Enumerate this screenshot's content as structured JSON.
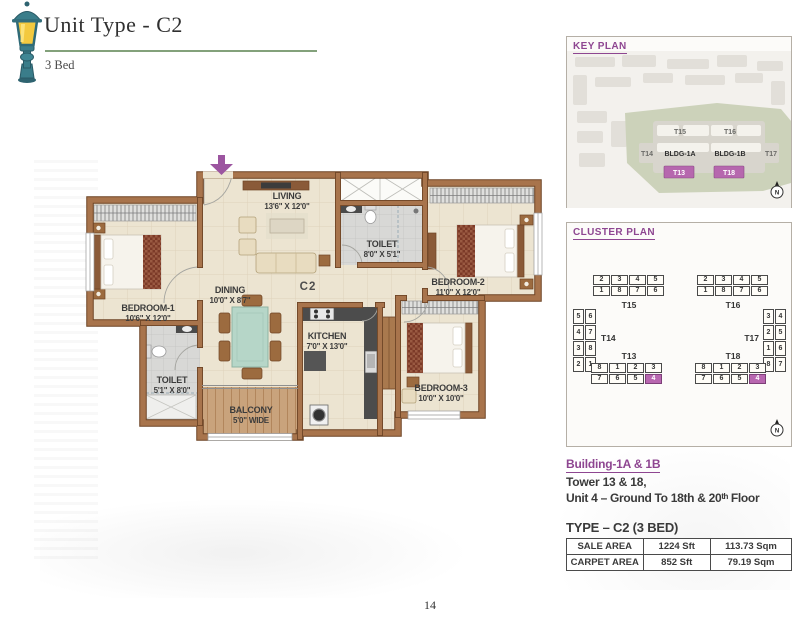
{
  "header": {
    "title": "Unit Type - C2",
    "subtitle": "3 Bed"
  },
  "page_number": "14",
  "accent": {
    "purple": "#8e4691",
    "highlight": "#b867b0",
    "green_rule": "#83a17b",
    "wall_brown": "#a8744c"
  },
  "plan": {
    "unit_label": "C2",
    "rooms": {
      "living": {
        "name": "LIVING",
        "dims": "13'6\" X 12'0\""
      },
      "toilet_top": {
        "name": "TOILET",
        "dims": "8'0\" X 5'1\""
      },
      "bedroom2": {
        "name": "BEDROOM-2",
        "dims": "11'0\" X 12'0\""
      },
      "bedroom1": {
        "name": "BEDROOM-1",
        "dims": "10'6\" X 12'0\""
      },
      "dining": {
        "name": "DINING",
        "dims": "10'0\" X 8'7\""
      },
      "kitchen": {
        "name": "KITCHEN",
        "dims": "7'0\" X 13'0\""
      },
      "toilet_bottom": {
        "name": "TOILET",
        "dims": "5'1\" X 8'0\""
      },
      "balcony": {
        "name": "BALCONY",
        "dims": "5'0\" WIDE"
      },
      "bedroom3": {
        "name": "BEDROOM-3",
        "dims": "10'0\" X 10'0\""
      }
    }
  },
  "key_plan": {
    "title": "KEY PLAN",
    "compass": "N",
    "labels": {
      "t15": "T15",
      "t16": "T16",
      "t14": "T14",
      "t17": "T17",
      "bldg1a": "BLDG-1A",
      "bldg1b": "BLDG-1B",
      "t13": "T13",
      "t18": "T18"
    }
  },
  "cluster_plan": {
    "title": "CLUSTER PLAN",
    "compass": "N",
    "left": {
      "top_label": "T15",
      "side_label": "T14",
      "bottom_label": "T13",
      "t_top_r1": [
        {
          "n": "2"
        },
        {
          "n": "3"
        },
        {
          "n": "4"
        },
        {
          "n": "5"
        }
      ],
      "t_top_r2": [
        {
          "n": "1"
        },
        {
          "n": "8"
        },
        {
          "n": "7"
        },
        {
          "n": "6"
        }
      ],
      "t_side_c1": [
        {
          "n": "5"
        },
        {
          "n": "4"
        },
        {
          "n": "3"
        },
        {
          "n": "2"
        }
      ],
      "t_side_c2": [
        {
          "n": "6"
        },
        {
          "n": "7"
        },
        {
          "n": "8"
        },
        {
          "n": "1"
        }
      ],
      "t_bottom_r1": [
        {
          "n": "8"
        },
        {
          "n": "1"
        },
        {
          "n": "2"
        },
        {
          "n": "3"
        }
      ],
      "t_bottom_r2": [
        {
          "n": "7"
        },
        {
          "n": "6"
        },
        {
          "n": "5"
        },
        {
          "n": "4",
          "hl": true
        }
      ]
    },
    "right": {
      "top_label": "T16",
      "side_label": "T17",
      "bottom_label": "T18",
      "t_top_r1": [
        {
          "n": "2"
        },
        {
          "n": "3"
        },
        {
          "n": "4"
        },
        {
          "n": "5"
        }
      ],
      "t_top_r2": [
        {
          "n": "1"
        },
        {
          "n": "8"
        },
        {
          "n": "7"
        },
        {
          "n": "6"
        }
      ],
      "t_side_c1": [
        {
          "n": "3"
        },
        {
          "n": "2"
        },
        {
          "n": "1"
        },
        {
          "n": "8"
        }
      ],
      "t_side_c2": [
        {
          "n": "4"
        },
        {
          "n": "5"
        },
        {
          "n": "6"
        },
        {
          "n": "7"
        }
      ],
      "t_bottom_r1": [
        {
          "n": "8"
        },
        {
          "n": "1"
        },
        {
          "n": "2"
        },
        {
          "n": "3"
        }
      ],
      "t_bottom_r2": [
        {
          "n": "7"
        },
        {
          "n": "6"
        },
        {
          "n": "5"
        },
        {
          "n": "4",
          "hl": true
        }
      ]
    }
  },
  "building_info": {
    "line1": "Building-1A & 1B",
    "line2": "Tower 13 & 18,",
    "line3": "Unit 4 – Ground To 18th & 20ᵗʰ Floor"
  },
  "type_title": "TYPE – C2 (3 BED)",
  "area_table": {
    "rows": [
      [
        "SALE AREA",
        "1224 Sft",
        "113.73 Sqm"
      ],
      [
        "CARPET AREA",
        "852 Sft",
        "79.19 Sqm"
      ]
    ]
  }
}
